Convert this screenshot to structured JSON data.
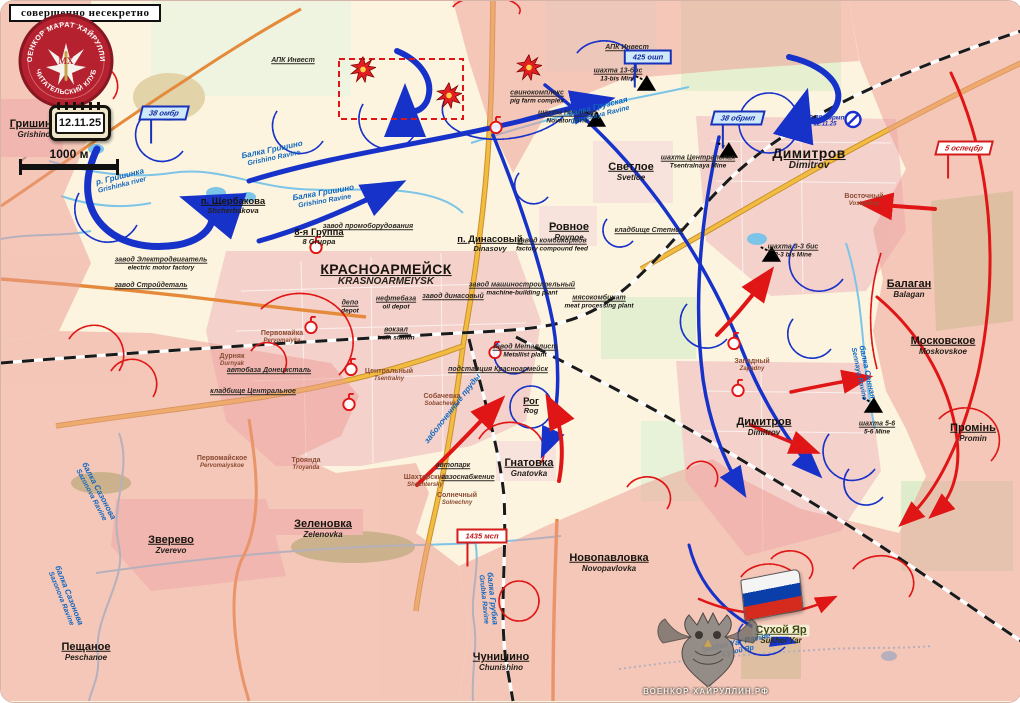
{
  "header": {
    "stamp": "совершенно несекретно",
    "emblem_top": "ВОЕНКОР МАРАТ ХАЙРУЛЛИН",
    "emblem_bottom": "ЧИТАТЕЛЬСКИЙ КЛУБ",
    "emblem_monogram": "МХ",
    "date": "12.11.25",
    "scale_label": "1000 м"
  },
  "watermark": {
    "site": "ВОЕНКОР-ХАЙРУЛЛИН.РФ"
  },
  "colors": {
    "field_cream": "#fcf4de",
    "occupied_pink": "#ec9e96",
    "urban_pink": "#f4d2cb",
    "road_yellow": "#f2bb42",
    "road_orange": "#e58a3a",
    "river_blue": "#7cc4e8",
    "blue_force": "#1732c8",
    "red_force": "#e01616",
    "railway_black": "#1a1a1a"
  },
  "map": {
    "settlements": [
      {
        "ru": "Гришино",
        "en": "Grishino",
        "x": 33,
        "y": 128,
        "cls": "md"
      },
      {
        "ru": "п. Щербакова",
        "en": "Shcherbakova",
        "x": 232,
        "y": 205,
        "cls": "sm"
      },
      {
        "ru": "8-я Группа",
        "en": "8 Gruppa",
        "x": 318,
        "y": 236,
        "cls": "sm"
      },
      {
        "ru": "КРАСНОАРМЕЙСК",
        "en": "KRASNOARMEIYSK",
        "x": 385,
        "y": 274,
        "cls": "lg"
      },
      {
        "ru": "п. Динасовый",
        "en": "Dinasovy",
        "x": 489,
        "y": 243,
        "cls": "sm"
      },
      {
        "ru": "Ровное",
        "en": "Rovnoe",
        "x": 568,
        "y": 231,
        "cls": "md"
      },
      {
        "ru": "Светлое",
        "en": "Svetloe",
        "x": 630,
        "y": 171,
        "cls": "md"
      },
      {
        "ru": "Димитров",
        "en": "Dimitrov",
        "x": 808,
        "y": 158,
        "cls": "lg"
      },
      {
        "ru": "Димитров",
        "en": "Dimitrov",
        "x": 763,
        "y": 426,
        "cls": "md"
      },
      {
        "ru": "Балаган",
        "en": "Balagan",
        "x": 908,
        "y": 288,
        "cls": "md"
      },
      {
        "ru": "Московское",
        "en": "Moskovskoe",
        "x": 942,
        "y": 345,
        "cls": "md"
      },
      {
        "ru": "Промінь",
        "en": "Promin",
        "x": 972,
        "y": 432,
        "cls": "md"
      },
      {
        "ru": "Рог",
        "en": "Rog",
        "x": 530,
        "y": 405,
        "cls": "sm"
      },
      {
        "ru": "Гнатовка",
        "en": "Gnatovka",
        "x": 528,
        "y": 467,
        "cls": "md"
      },
      {
        "ru": "Зеленовка",
        "en": "Zelenovka",
        "x": 322,
        "y": 528,
        "cls": "md"
      },
      {
        "ru": "Зверево",
        "en": "Zverevo",
        "x": 170,
        "y": 544,
        "cls": "md"
      },
      {
        "ru": "Пещаное",
        "en": "Peschanoe",
        "x": 85,
        "y": 651,
        "cls": "md"
      },
      {
        "ru": "Чунишино",
        "en": "Chunishino",
        "x": 500,
        "y": 661,
        "cls": "md"
      },
      {
        "ru": "Новопавловка",
        "en": "Novopavlovka",
        "x": 608,
        "y": 562,
        "cls": "md"
      },
      {
        "ru": "Сухой Яр",
        "en": "Sukhoi Yar",
        "x": 780,
        "y": 634,
        "cls": "md olive"
      },
      {
        "ru": "Первомайское",
        "en": "Pervomaiyskoe",
        "x": 221,
        "y": 461,
        "cls": "xs"
      },
      {
        "ru": "Троянда",
        "en": "Troyanda",
        "x": 305,
        "y": 463,
        "cls": "xs"
      },
      {
        "ru": "Первомайка",
        "en": "Pervomaiyka",
        "x": 281,
        "y": 336,
        "cls": "xs"
      },
      {
        "ru": "Дурняк",
        "en": "Durnyak",
        "x": 231,
        "y": 359,
        "cls": "xs"
      },
      {
        "ru": "Собачевка",
        "en": "Sobachevka",
        "x": 441,
        "y": 399,
        "cls": "xs"
      },
      {
        "ru": "Шахтерский",
        "en": "Shachtersky",
        "x": 424,
        "y": 480,
        "cls": "xs"
      },
      {
        "ru": "Солнечный",
        "en": "Solnechny",
        "x": 456,
        "y": 498,
        "cls": "xs"
      },
      {
        "ru": "Центральный",
        "en": "Tsentralny",
        "x": 388,
        "y": 374,
        "cls": "xs"
      },
      {
        "ru": "Западный",
        "en": "Zapadny",
        "x": 751,
        "y": 364,
        "cls": "xs"
      },
      {
        "ru": "Восточный",
        "en": "Vostochny",
        "x": 863,
        "y": 199,
        "cls": "xs"
      }
    ],
    "infrastructure": [
      {
        "ru": "свинокомплекс",
        "en": "pig farm complex",
        "x": 536,
        "y": 96
      },
      {
        "ru": "шахта 13-бис",
        "en": "13-bis Mine",
        "x": 617,
        "y": 74
      },
      {
        "ru": "шахта Новатор",
        "en": "Novator Mine",
        "x": 566,
        "y": 116
      },
      {
        "ru": "шахта Центральная",
        "en": "Tsentralnaya Mine",
        "x": 697,
        "y": 161
      },
      {
        "ru": "шахта 3-3 бис",
        "en": "3-3 bis Mine",
        "x": 792,
        "y": 250
      },
      {
        "ru": "шахта 5-6",
        "en": "5-6 Mine",
        "x": 876,
        "y": 427
      },
      {
        "ru": "АПК Инвест",
        "en": "",
        "x": 292,
        "y": 60
      },
      {
        "ru": "АПК Инвест",
        "en": "",
        "x": 626,
        "y": 47
      },
      {
        "ru": "завод Электродвигатель",
        "en": "electric motor factory",
        "x": 160,
        "y": 263
      },
      {
        "ru": "завод Стройдеталь",
        "en": "",
        "x": 150,
        "y": 285
      },
      {
        "ru": "завод промоборудования",
        "en": "",
        "x": 367,
        "y": 226
      },
      {
        "ru": "нефтебаза",
        "en": "oil depot",
        "x": 395,
        "y": 302
      },
      {
        "ru": "депо",
        "en": "depot",
        "x": 349,
        "y": 306
      },
      {
        "ru": "вокзал",
        "en": "train station",
        "x": 395,
        "y": 333
      },
      {
        "ru": "завод динасовый",
        "en": "",
        "x": 452,
        "y": 296
      },
      {
        "ru": "завод машиностроительный",
        "en": "machine-building plant",
        "x": 521,
        "y": 288
      },
      {
        "ru": "завод комбикормов",
        "en": "factory compound feed",
        "x": 551,
        "y": 244
      },
      {
        "ru": "мясокомбинат",
        "en": "meat processing plant",
        "x": 598,
        "y": 301
      },
      {
        "ru": "завод Металлист",
        "en": "Metallist plant",
        "x": 524,
        "y": 350
      },
      {
        "ru": "подстанция Красноармейск",
        "en": "",
        "x": 497,
        "y": 369
      },
      {
        "ru": "автобаза Донецксталь",
        "en": "",
        "x": 268,
        "y": 370
      },
      {
        "ru": "кладбище Центральное",
        "en": "",
        "x": 252,
        "y": 391
      },
      {
        "ru": "автопарк",
        "en": "",
        "x": 452,
        "y": 465
      },
      {
        "ru": "газоснабжение",
        "en": "",
        "x": 467,
        "y": 477
      },
      {
        "ru": "кладбище Степное",
        "en": "",
        "x": 648,
        "y": 230
      }
    ],
    "water_labels": [
      {
        "ru": "р. Гришинка",
        "en": "Grishinka river",
        "x": 120,
        "y": 180,
        "rot": -14
      },
      {
        "ru": "Балка Гришино",
        "en": "Grishino Ravine",
        "x": 272,
        "y": 153,
        "rot": -12
      },
      {
        "ru": "Балка Гришино",
        "en": "Grishino Ravine",
        "x": 323,
        "y": 196,
        "rot": -10
      },
      {
        "ru": "балка Грузская",
        "en": "Gruzskaya Ravine",
        "x": 598,
        "y": 110,
        "rot": -14
      },
      {
        "ru": "балка Сазонова",
        "en": "Sazonova Ravine",
        "x": 94,
        "y": 492,
        "rot": 62
      },
      {
        "ru": "балка Сазонова",
        "en": "Sazonova Ravine",
        "x": 64,
        "y": 596,
        "rot": 68
      },
      {
        "ru": "балка Сенная",
        "en": "Sennaya Ravine",
        "x": 862,
        "y": 372,
        "rot": 78
      },
      {
        "ru": "балка Грубка",
        "en": "Grubka Ravine",
        "x": 487,
        "y": 598,
        "rot": 84
      },
      {
        "ru": "Sukhoi Yar Ravine",
        "en": "Сухой Яр",
        "x": 736,
        "y": 646,
        "rot": -12
      },
      {
        "ru": "заболоченные пруды",
        "en": "",
        "x": 452,
        "y": 408,
        "rot": -52
      }
    ],
    "unit_labels": [
      {
        "text": "38 омбр",
        "sub": "",
        "color": "blue",
        "type": "pennant",
        "x": 163,
        "y": 112
      },
      {
        "text": "38 обрмп",
        "sub": "",
        "color": "blue",
        "type": "pennant",
        "x": 737,
        "y": 117
      },
      {
        "text": "425 ошп",
        "sub": "",
        "color": "blue",
        "type": "box",
        "x": 647,
        "y": 56
      },
      {
        "text": "30-38 обрмп",
        "sub": "12.11.25",
        "color": "blue",
        "type": "plain",
        "x": 824,
        "y": 120
      },
      {
        "text": "5 оспецбр",
        "sub": "",
        "color": "red",
        "type": "pennant",
        "x": 963,
        "y": 147
      },
      {
        "text": "1435 мсп",
        "sub": "",
        "color": "red",
        "type": "box",
        "x": 481,
        "y": 535
      }
    ],
    "symbols": {
      "mines": [
        {
          "x": 644,
          "y": 84
        },
        {
          "x": 594,
          "y": 120
        },
        {
          "x": 726,
          "y": 151
        },
        {
          "x": 769,
          "y": 255
        },
        {
          "x": 871,
          "y": 406
        }
      ],
      "explosions": [
        {
          "x": 362,
          "y": 71
        },
        {
          "x": 448,
          "y": 97
        },
        {
          "x": 528,
          "y": 69
        }
      ],
      "strongpoints": [
        {
          "x": 315,
          "y": 247
        },
        {
          "x": 310,
          "y": 327
        },
        {
          "x": 350,
          "y": 369
        },
        {
          "x": 348,
          "y": 404
        },
        {
          "x": 494,
          "y": 352
        },
        {
          "x": 733,
          "y": 343
        },
        {
          "x": 737,
          "y": 390
        },
        {
          "x": 495,
          "y": 127
        }
      ],
      "no_entry": {
        "x": 852,
        "y": 121
      }
    }
  }
}
